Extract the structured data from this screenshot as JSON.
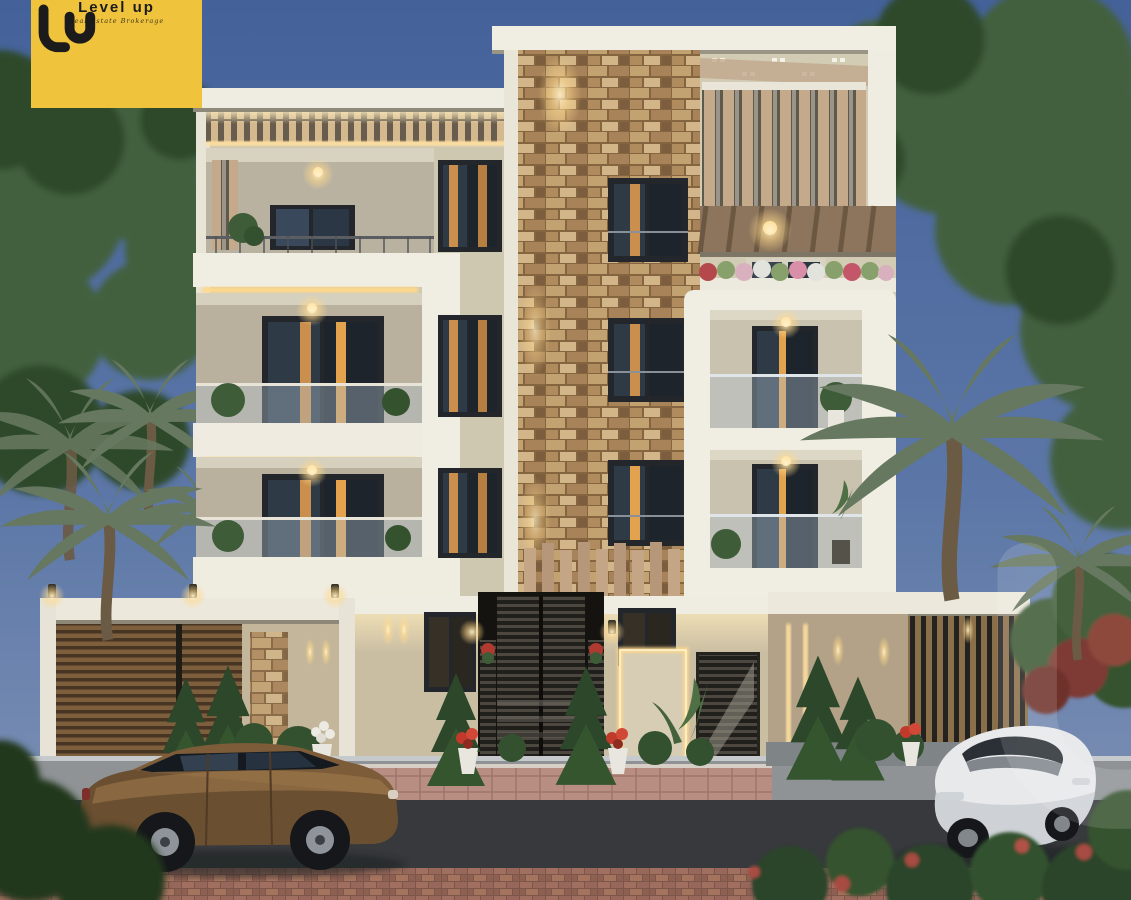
{
  "logo": {
    "monogram": "lu",
    "wordmark": "Level up",
    "tagline": "Real Estate Brokerage",
    "background_color": "#F0C33C",
    "text_color": "#1B1B1B"
  },
  "watermark": {
    "glyph": "lu",
    "color": "#FFFFFF",
    "opacity": 0.13
  },
  "scene": {
    "subject": "Four-storey residential building exterior render at dusk",
    "vehicles": [
      "bronze station wagon",
      "white sedan"
    ],
    "palette": {
      "sky_top": "#44619A",
      "sky_bottom": "#8295B7",
      "facade_cream": "#CFC8B0",
      "trim_white": "#F0EDE2",
      "stone_tan": "#B5925F",
      "wood_slat": "#8A6A46",
      "warm_light": "#FFD98C",
      "window_glass": "#1D242C",
      "curtain_warm": "#E2A24E",
      "foliage_dark": "#2F4A2C",
      "palm_green": "#5E7258",
      "road_asphalt": "#37393C",
      "sidewalk_gray": "#8F9396",
      "paving_pink": "#B98E82",
      "brick_red": "#9C6A5C",
      "car_bronze": "#7D5C39",
      "car_white": "#E7E9EB"
    }
  }
}
